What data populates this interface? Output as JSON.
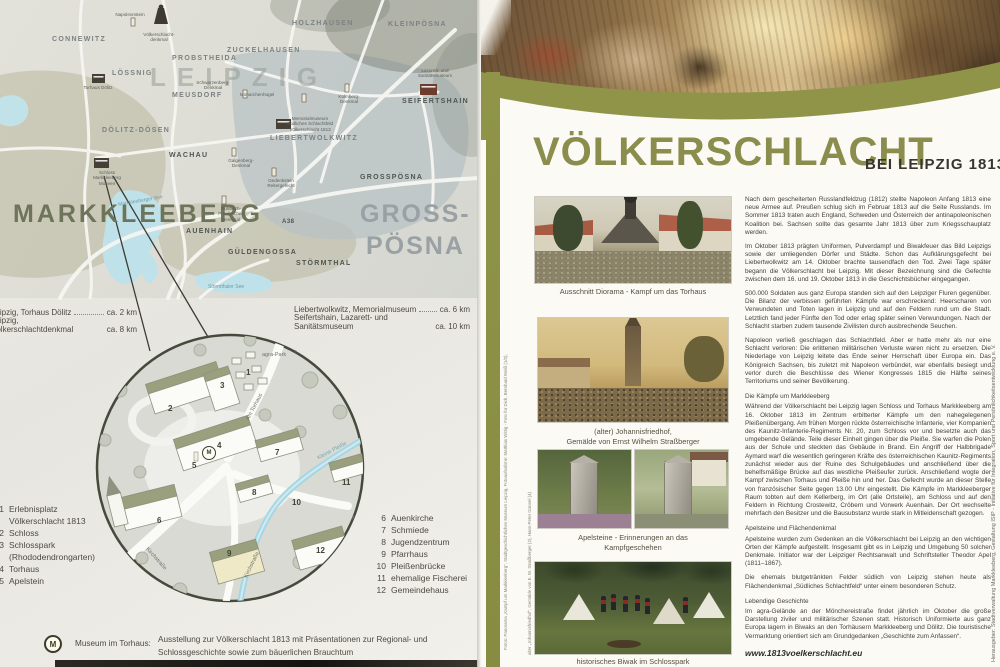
{
  "title": {
    "main": "VÖLKERSCHLACHT",
    "sub": "BEI LEIPZIG 1813"
  },
  "article": {
    "p1": "Nach dem gescheiterten Russlandfeldzug (1812) stellte Napoleon Anfang 1813 eine neue Armee auf. Preußen schlug sich im Februar 1813 auf die Seite Russlands. Im Sommer 1813 traten auch England, Schweden und Österreich der antinapoleonischen Koalition bei. Sachsen sollte das gesamte Jahr 1813 über zum Kriegsschauplatz werden.",
    "p2": "Im Oktober 1813 prägten Uniformen, Pulverdampf und Biwakfeuer das Bild Leipzigs sowie der umliegenden Dörfer und Städte. Schon das Aufklärungsgefecht bei Liebertwolkwitz am 14. Oktober brachte tausendfach den Tod. Zwei Tage später begann die Völkerschlacht bei Leipzig. Mit dieser Bezeichnung sind die Gefechte zwischen dem 16. und 19. Oktober 1813 in die Geschichtsbücher eingegangen.",
    "p3": "500.000 Soldaten aus ganz Europa standen sich auf den Leipziger Fluren gegenüber. Die Bilanz der verbissen geführten Kämpfe war erschreckend: Heerscharen von Verwundeten und Toten lagen in Leipzig und auf den Feldern rund um die Stadt. Letztlich fand jeder Fünfte den Tod oder erlag später seinen Verwundungen. Nach der Schlacht starben zudem tausende Zivilisten durch ausbrechende Seuchen.",
    "p4": "Napoleon verließ geschlagen das Schlachtfeld. Aber er hatte mehr als nur eine Schlacht verloren: Die erlittenen militärischen Verluste waren nicht zu ersetzen. Die Niederlage von Leipzig leitete das Ende seiner Herrschaft über Europa ein. Das Königreich Sachsen, bis zuletzt mit Napoleon verbündet, war ebenfalls besiegt und verlor durch die Beschlüsse des Wiener Kongresses 1815 die Hälfte seines Territoriums und seiner Bevölkerung.",
    "h_markkleeberg": "Die Kämpfe um Markkleeberg",
    "p5": "Während der Völkerschlacht bei Leipzig lagen Schloss und Torhaus Markkleeberg am 16. Oktober 1813 im Zentrum erbitterter Kämpfe um den nahegelegenen Pleißenübergang. Am frühen Morgen rückte österreichische Infanterie, vier Kompanien des Kaunitz-Infanterie-Regiments Nr. 20, zum Schloss vor und besetzte auch das umgebende Gelände. Teile dieser Einheit gingen über die Pleiße. Sie warfen die Polen aus der Schule und steckten das Gebäude in Brand. Ein Angriff der Halbbrigade Aymard warf die wesentlich geringeren Kräfte des österreichischen Kaunitz-Regiments zunächst wieder aus der Ruine des Schulgebäudes und anschließend über die behelfsmäßige Brücke auf das westliche Pleißeufer zurück. Anschließend wogte der Kampf zwischen Torhaus und Pleiße hin und her. Das Gefecht wurde an dieser Stelle von französischer Seite gegen 13.00 Uhr eingestellt. Die Kämpfe im Markkleeberger Raum tobten auf dem Kellerberg, im Ort (alle Ortsteile), am Schloss und auf den Feldern in Richtung Crostewitz, Cröbern und Vorwerk Auenhain. Der Ort wechselte mehrfach den Besitzer und die Bausubstanz wurde stark in Mitleidenschaft gezogen.",
    "h_apelsteine": "Apelsteine und Flächendenkmal",
    "p6": "Apelsteine wurden zum Gedenken an die Völkerschlacht bei Leipzig an den wichtigen Orten der Kämpfe aufgestellt. Insgesamt gibt es in Leipzig und Umgebung 50 solcher Denkmale. Initiator war der Leipziger Rechtsanwalt und Schriftsteller Theodor Apel (1811–1867).",
    "p7": "Die ehemals blutgetränkten Felder südlich von Leipzig stehen heute als Flächendenkmal „Südliches Schlachtfeld“ unter einem besonderen Schutz.",
    "h_geschichte": "Lebendige Geschichte",
    "p8": "Im agra-Gelände an der Mönchereistraße findet jährlich im Oktober die große Darstellung ziviler und militärischer Szenen statt. Historisch Uniformierte aus ganz Europa lagern in Biwaks an den Torhäusern Markkleeberg und Dölitz. Die touristische Vermarktung orientiert sich am Grundgedanken „Geschichte zum Anfassen“.",
    "website": "www.1813voelkerschlacht.eu"
  },
  "captions": {
    "c1": "Ausschnitt Diorama - Kampf um das Torhaus",
    "c2a": "(alter) Johannisfriedhof,",
    "c2b": "Gemälde von Ernst Wilhelm Straßberger",
    "c3a": "Apelsteine - Erinnerungen an das",
    "c3b": "Kampfgeschehen",
    "c4": "historisches Biwak im Schlosspark"
  },
  "credits": {
    "publisher": "Herausgeber:    Stadtverwaltung Markkleeberg, Gestaltung ISIP - Initiative für Integration, Sport und Persönlichkeitsentwicklung e. V.",
    "photos1": "Fotos: Panorama „Kampf um Markkleeberg“, Stadtgeschichtliches Museum Leipzig, Fotoaufnahme: Matthias Wittig - Foto für Dich, Bernhard Weiß (1/3),",
    "photos2": "alter „Johannisfriedhof“, Gemälde von E. W. Straßberger (2), Hans-Peter Günnel (4)"
  },
  "map": {
    "leipzig": "LEIPZIG",
    "markkleeberg": "MARKKLEEBERG",
    "gross1": "GROSS-",
    "gross2": "PÖSNA",
    "towns": [
      "CONNEWITZ",
      "LÖSSNIG",
      "PROBSTHEIDA",
      "ZUCKELHAUSEN",
      "HOLZHAUSEN",
      "KLEINPÖSNA",
      "MEUSDORF",
      "DÖLITZ-DÖSEN",
      "WACHAU",
      "LIEBERTWOLKWITZ",
      "GROSSPÖSNA",
      "SEIFERTSHAIN",
      "AUENHAIN",
      "GÜLDENGOSSA",
      "STÖRMTHAL",
      "A38"
    ],
    "lakes": [
      "Markkleeberger See",
      "Störmthaler See"
    ],
    "poi": [
      "Napoleonstein",
      "Völkerschlacht- denkmal",
      "Schwarzenberg- Denkmal",
      "Torhaus Dölitz",
      "Schloss Markkleeberg Museen",
      "Memorialmuseum Südliches Schlachtfeld Völkerschlacht 1813",
      "Lazarett- und Sanitätsmuseum",
      "Kolmberg- Denkmal",
      "Galgenberg- Denkmal",
      "Russisch- Preußisches Denkmal",
      "Gedenkstein Reitergefecht",
      "Monarchenhügel"
    ]
  },
  "distances": {
    "left": [
      {
        "label": "Leipzig, Torhaus Dölitz",
        "value": "ca. 2 km"
      },
      {
        "label": "Leipzig, Völkerschlachtdenkmal",
        "value": "ca. 8 km"
      }
    ],
    "right": [
      {
        "label": "Liebertwolkwitz, Memorialmuseum",
        "value": "ca. 6 km"
      },
      {
        "label": "Seifertshain, Lazarett- und Sanitätsmuseum",
        "value": "ca. 10 km"
      }
    ]
  },
  "legend": {
    "left": [
      {
        "num": "1",
        "label": "Erlebnisplatz",
        "label2": "Völkerschlacht 1813"
      },
      {
        "num": "2",
        "label": "Schloss"
      },
      {
        "num": "3",
        "label": "Schlosspark",
        "label2": "(Rhododendrongarten)"
      },
      {
        "num": "4",
        "label": "Torhaus"
      },
      {
        "num": "5",
        "label": "Apelstein"
      }
    ],
    "right": [
      {
        "num": "6",
        "label": "Auenkirche"
      },
      {
        "num": "7",
        "label": "Schmiede"
      },
      {
        "num": "8",
        "label": "Jugendzentrum"
      },
      {
        "num": "9",
        "label": "Pfarrhaus"
      },
      {
        "num": "10",
        "label": "Pleißenbrücke"
      },
      {
        "num": "11",
        "label": "ehemalige Fischerei"
      },
      {
        "num": "12",
        "label": "Gemeindehaus"
      }
    ]
  },
  "inset": {
    "streets": [
      "agra-Park",
      "Am Torhaus",
      "Kleine Pleiße",
      "Kirchstraße",
      "Kirchstraße"
    ],
    "arrow": "↑"
  },
  "museum_note": {
    "icon": "M",
    "title": "Museum im Torhaus:",
    "line1": "Ausstellung zur Völkerschlacht 1813 mit Präsentationen zur Regional- und",
    "line2": "Schlossgeschichte sowie zum bäuerlichen Brauchtum"
  },
  "colors": {
    "accent_olive": "#8f9449",
    "title_olive": "#8b8d4c",
    "map_dark_olive": "#6e7459"
  }
}
